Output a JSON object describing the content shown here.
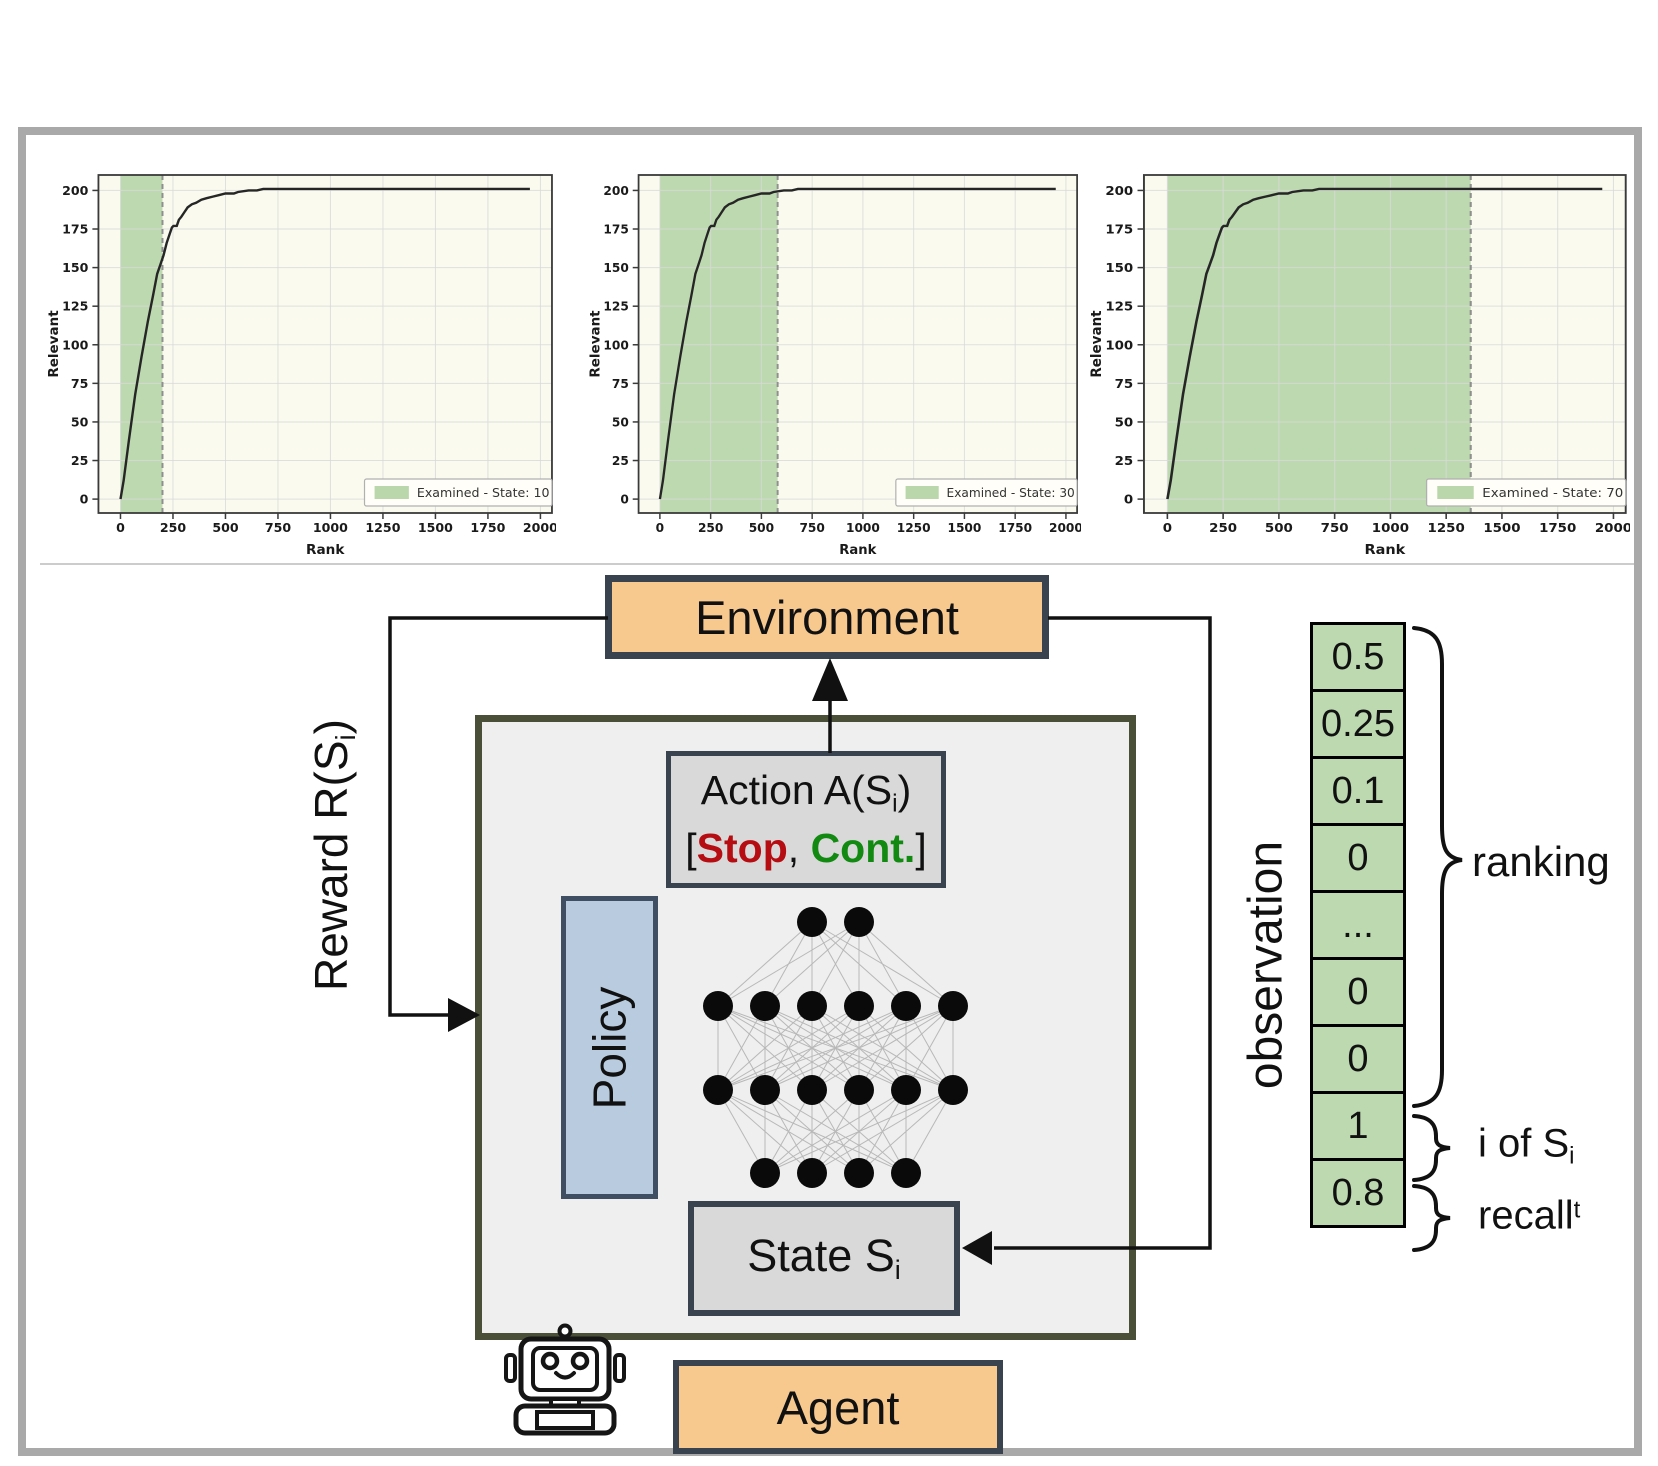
{
  "colors": {
    "stop": "#b50d12",
    "cont": "#128a12",
    "box_orange": "#f8c98f",
    "box_gray": "#d9d9d9",
    "box_blue": "#b9cbdf",
    "agent_bg": "#efefef",
    "agent_border": "#4a4f38",
    "box_border": "#39434f",
    "cell_green": "#bdd9b0",
    "region_green": "#b9d7ab",
    "plot_bg": "#fafaef",
    "frame_gray": "#a9a9a9"
  },
  "chart_common": {
    "type": "line",
    "xlabel": "Rank",
    "ylabel": "Relevant",
    "x_ticks": [
      0,
      250,
      500,
      750,
      1000,
      1250,
      1500,
      1750,
      2000
    ],
    "y_ticks": [
      0,
      25,
      50,
      75,
      100,
      125,
      150,
      175,
      200
    ],
    "xlim": [
      -105,
      2055
    ],
    "ylim": [
      -9,
      210
    ],
    "grid": true,
    "legend_position": "lower right",
    "series_name": "cumulative relevant found",
    "curve": [
      [
        0,
        0
      ],
      [
        15,
        12
      ],
      [
        40,
        38
      ],
      [
        70,
        68
      ],
      [
        100,
        92
      ],
      [
        130,
        115
      ],
      [
        155,
        132
      ],
      [
        175,
        146
      ],
      [
        190,
        152
      ],
      [
        205,
        158
      ],
      [
        220,
        166
      ],
      [
        235,
        172
      ],
      [
        245,
        176
      ],
      [
        252,
        177
      ],
      [
        268,
        177
      ],
      [
        278,
        181
      ],
      [
        290,
        183
      ],
      [
        305,
        186
      ],
      [
        320,
        189
      ],
      [
        340,
        191
      ],
      [
        360,
        192
      ],
      [
        385,
        194
      ],
      [
        410,
        195
      ],
      [
        440,
        196
      ],
      [
        470,
        197
      ],
      [
        500,
        198
      ],
      [
        540,
        198
      ],
      [
        560,
        199
      ],
      [
        610,
        200
      ],
      [
        650,
        200
      ],
      [
        680,
        201
      ],
      [
        1950,
        201
      ]
    ]
  },
  "chart_data": [
    {
      "legend": "Examined - State: 10",
      "examined_to": 200
    },
    {
      "legend": "Examined - State: 30",
      "examined_to": 580
    },
    {
      "legend": "Examined - State: 70",
      "examined_to": 1360
    }
  ],
  "diagram": {
    "environment_label": "Environment",
    "agent_label": "Agent",
    "policy_label": "Policy",
    "action": {
      "line1_prefix": "Action A(S",
      "line1_sub": "i",
      "line1_suffix": ")",
      "open": "[",
      "stop": "Stop",
      "sep": ", ",
      "cont": "Cont.",
      "close": "]"
    },
    "state": {
      "prefix": "State S",
      "sub": "i"
    },
    "reward": {
      "prefix": "Reward R(S",
      "sub": "i",
      "suffix": ")"
    },
    "network_layers": [
      2,
      6,
      6,
      4
    ]
  },
  "observation": {
    "label": "observation",
    "cells": [
      "0.5",
      "0.25",
      "0.1",
      "0",
      "...",
      "0",
      "0",
      "1",
      "0.8"
    ],
    "ranking_label": "ranking",
    "i_of": {
      "prefix": "i of S",
      "sub": "i"
    },
    "recall": {
      "base": "recall",
      "sup": "t"
    }
  }
}
